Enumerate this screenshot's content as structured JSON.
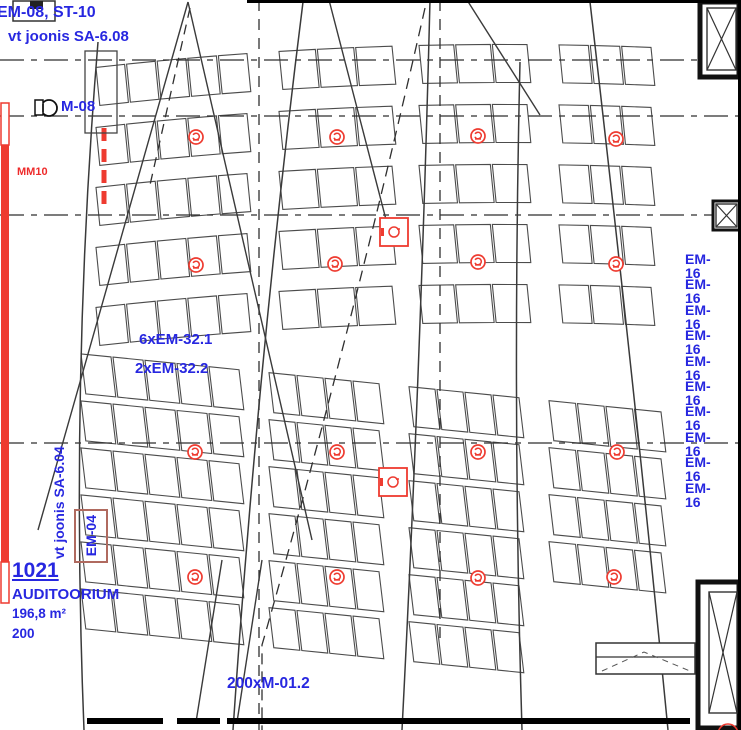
{
  "labels": {
    "top_ref": "EM-08, ST-10",
    "top_ref_note": "vt joonis SA-6.08",
    "device_m08": "M-08",
    "mm10": "MM10",
    "em32_line1": "6xEM-32.1",
    "em32_line2": "2xEM-32.2",
    "side_note": "vt joonis SA-6.04",
    "em04": "EM-04",
    "bottom_ref": "200xM-01.2"
  },
  "room": {
    "number": "1021",
    "name": "AUDITOORIUM",
    "area": "196,8 m²",
    "capacity": "200"
  },
  "em16": {
    "label": "EM-16",
    "count": 10,
    "x": 685,
    "y_start": 259,
    "y_step": 25.4
  },
  "colors": {
    "blue": "#2727e0",
    "red": "#ee3b30",
    "line": "#4c4c4c",
    "dark": "#111111",
    "box_red": "#b06a5f"
  },
  "plan": {
    "banks": [
      {
        "name": "upper-seat-bank",
        "row_count": 5,
        "top": 45,
        "pitch": 60,
        "depth": 38,
        "curve": {
          "cx": 442,
          "a": -0.0172,
          "b": 0.0001378
        },
        "lean": 0.1,
        "seat_w": 33,
        "sections": [
          [
            95,
            248
          ],
          [
            278,
            393
          ],
          [
            418,
            528
          ],
          [
            558,
            652
          ]
        ],
        "section_rows": [
          5,
          5,
          5,
          5
        ]
      },
      {
        "name": "lower-seat-bank",
        "row_count": 6,
        "top": 390,
        "pitch": 47,
        "depth": 40,
        "curve": {
          "cx": 442,
          "a": 0.1,
          "b": 0.0
        },
        "lean": 0.12,
        "seat_w": 31,
        "sections": [
          [
            80,
            240
          ],
          [
            268,
            380
          ],
          [
            408,
            520
          ],
          [
            548,
            662
          ]
        ],
        "section_rows": [
          6,
          6,
          6,
          4
        ]
      }
    ],
    "aisle_curves": [
      "M98,42 Q70,380 84,730",
      "M303,2 Q258,360 233,730",
      "M430,0 Q421,360 402,730",
      "M520,62 Q512,400 522,730",
      "M590,2 Q636,400 668,730"
    ],
    "sight_lines": [
      [
        188,
        2,
        38,
        530
      ],
      [
        188,
        2,
        312,
        540
      ],
      [
        467,
        0,
        540,
        115
      ],
      [
        329,
        0,
        390,
        235
      ],
      [
        222,
        560,
        196,
        722
      ],
      [
        262,
        560,
        237,
        722
      ]
    ],
    "dashed_horizontal": [
      60,
      116,
      215,
      443
    ],
    "dashed_vertical": [
      {
        "x": 259,
        "y1": 0,
        "y2": 730
      },
      {
        "x": 440,
        "y1": 0,
        "y2": 640
      }
    ],
    "dashed_curve": "M425,8 Q352,330 262,645 L262,730",
    "dashed_diag": [
      190,
      8,
      150,
      185
    ],
    "symbols": {
      "circles": [
        [
          196,
          137
        ],
        [
          337,
          137
        ],
        [
          478,
          136
        ],
        [
          616,
          139
        ],
        [
          196,
          265
        ],
        [
          335,
          264
        ],
        [
          478,
          262
        ],
        [
          616,
          264
        ],
        [
          195,
          452
        ],
        [
          337,
          452
        ],
        [
          478,
          452
        ],
        [
          617,
          452
        ],
        [
          195,
          577
        ],
        [
          337,
          577
        ],
        [
          478,
          578
        ],
        [
          614,
          577
        ]
      ],
      "squares": [
        [
          394,
          232
        ],
        [
          393,
          482
        ]
      ]
    },
    "red_wall": {
      "x": 1,
      "w": 8,
      "solid_y1": 145,
      "solid_y2": 562,
      "outline": [
        [
          103,
          42
        ],
        [
          562,
          41
        ]
      ]
    },
    "red_dash_strip": {
      "x": 104,
      "y1": 128,
      "y2": 212
    },
    "columns": {
      "top_right": {
        "x": 700,
        "y": 2,
        "w": 39,
        "h": 75,
        "inner": [
          707,
          8,
          29,
          62
        ]
      },
      "small_right": {
        "x": 713,
        "y": 201,
        "w": 27,
        "h": 29
      },
      "bottom_right": {
        "x": 698,
        "y": 582,
        "w": 41,
        "h": 146,
        "inner": [
          709,
          592,
          28,
          121
        ]
      }
    },
    "beam": {
      "x": 596,
      "y": 643,
      "w": 99,
      "h": 31
    },
    "borders": {
      "top": [
        247,
        741
      ],
      "right_x": 739.5,
      "bottom_y": 721,
      "bottom_segs": [
        [
          87,
          163
        ],
        [
          177,
          220
        ],
        [
          227,
          690
        ]
      ]
    },
    "m08_symbol": {
      "cx": 49,
      "cy": 108,
      "r": 8
    },
    "equip_rect": [
      85,
      51,
      32,
      82
    ],
    "top_left_rect": [
      13,
      1,
      42,
      20
    ],
    "top_left_fill": [
      30,
      1,
      13,
      8
    ],
    "red_arc_br": {
      "cx": 728,
      "cy": 734,
      "r": 10
    }
  }
}
